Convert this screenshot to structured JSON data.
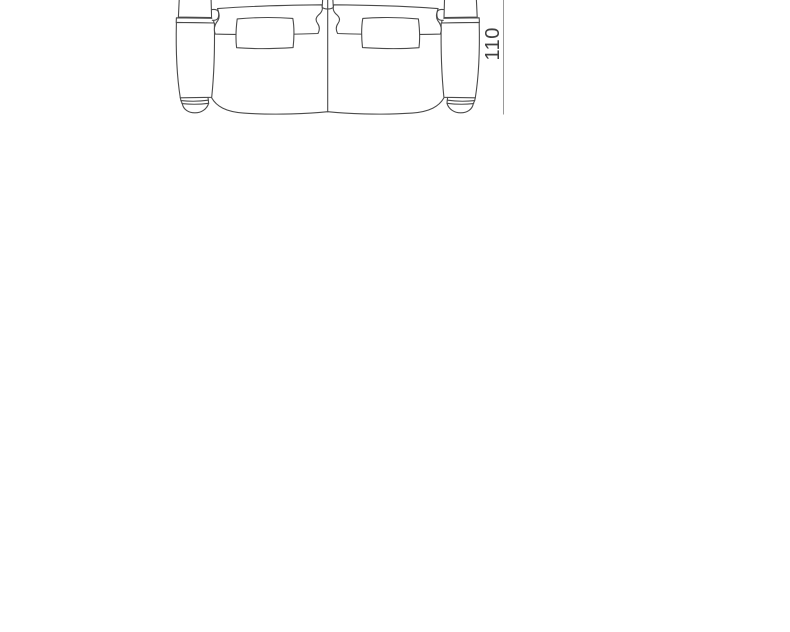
{
  "page": {
    "background": "#ffffff"
  },
  "drawing": {
    "subject": "two-seat-sofa-top-view",
    "line_color": "#4a4a4a",
    "fill_color": "#ffffff",
    "dimension": {
      "label": "110",
      "orientation": "vertical",
      "line_color": "#9a9a9a",
      "text_color": "#3f3f3f"
    }
  }
}
